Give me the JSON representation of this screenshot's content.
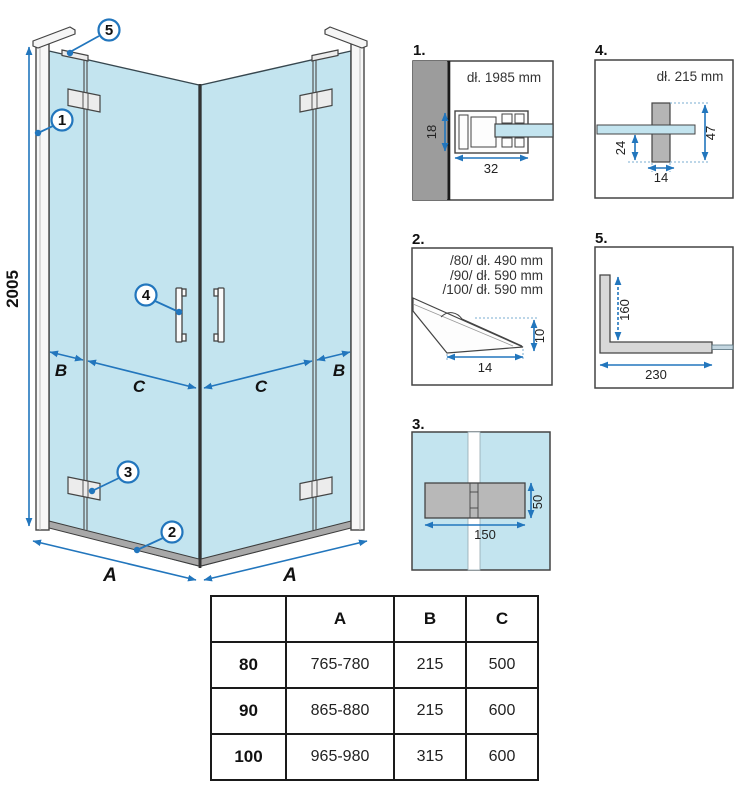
{
  "colors": {
    "glass": "#c3e4ef",
    "dimension_blue": "#2276bd",
    "wall_gray": "#9c9c9c",
    "hinge_gray": "#b8b8b8",
    "outline": "#3f3f3f"
  },
  "main_diagram": {
    "height_dim": "2005",
    "width_dim_left": "A",
    "width_dim_right": "A",
    "dim_b_left": "B",
    "dim_b_right": "B",
    "dim_c_left": "C",
    "dim_c_right": "C",
    "callout_1": "1",
    "callout_2": "2",
    "callout_3": "3",
    "callout_4": "4",
    "callout_5": "5"
  },
  "details": {
    "d1": {
      "label": "1.",
      "length": "dł. 1985 mm",
      "height": "18",
      "width": "32"
    },
    "d2": {
      "label": "2.",
      "line1": "/80/ dł. 490 mm",
      "line2": "/90/ dł. 590 mm",
      "line3": "/100/ dł. 590 mm",
      "height": "10",
      "width": "14"
    },
    "d3": {
      "label": "3.",
      "height": "50",
      "width": "150"
    },
    "d4": {
      "label": "4.",
      "length": "dł. 215 mm",
      "offset": "24",
      "height": "47",
      "width": "14"
    },
    "d5": {
      "label": "5.",
      "height": "160",
      "width": "230"
    }
  },
  "table": {
    "col_a": "A",
    "col_b": "B",
    "col_c": "C",
    "rows": [
      {
        "size": "80",
        "a": "765-780",
        "b": "215",
        "c": "500"
      },
      {
        "size": "90",
        "a": "865-880",
        "b": "215",
        "c": "600"
      },
      {
        "size": "100",
        "a": "965-980",
        "b": "315",
        "c": "600"
      }
    ]
  }
}
